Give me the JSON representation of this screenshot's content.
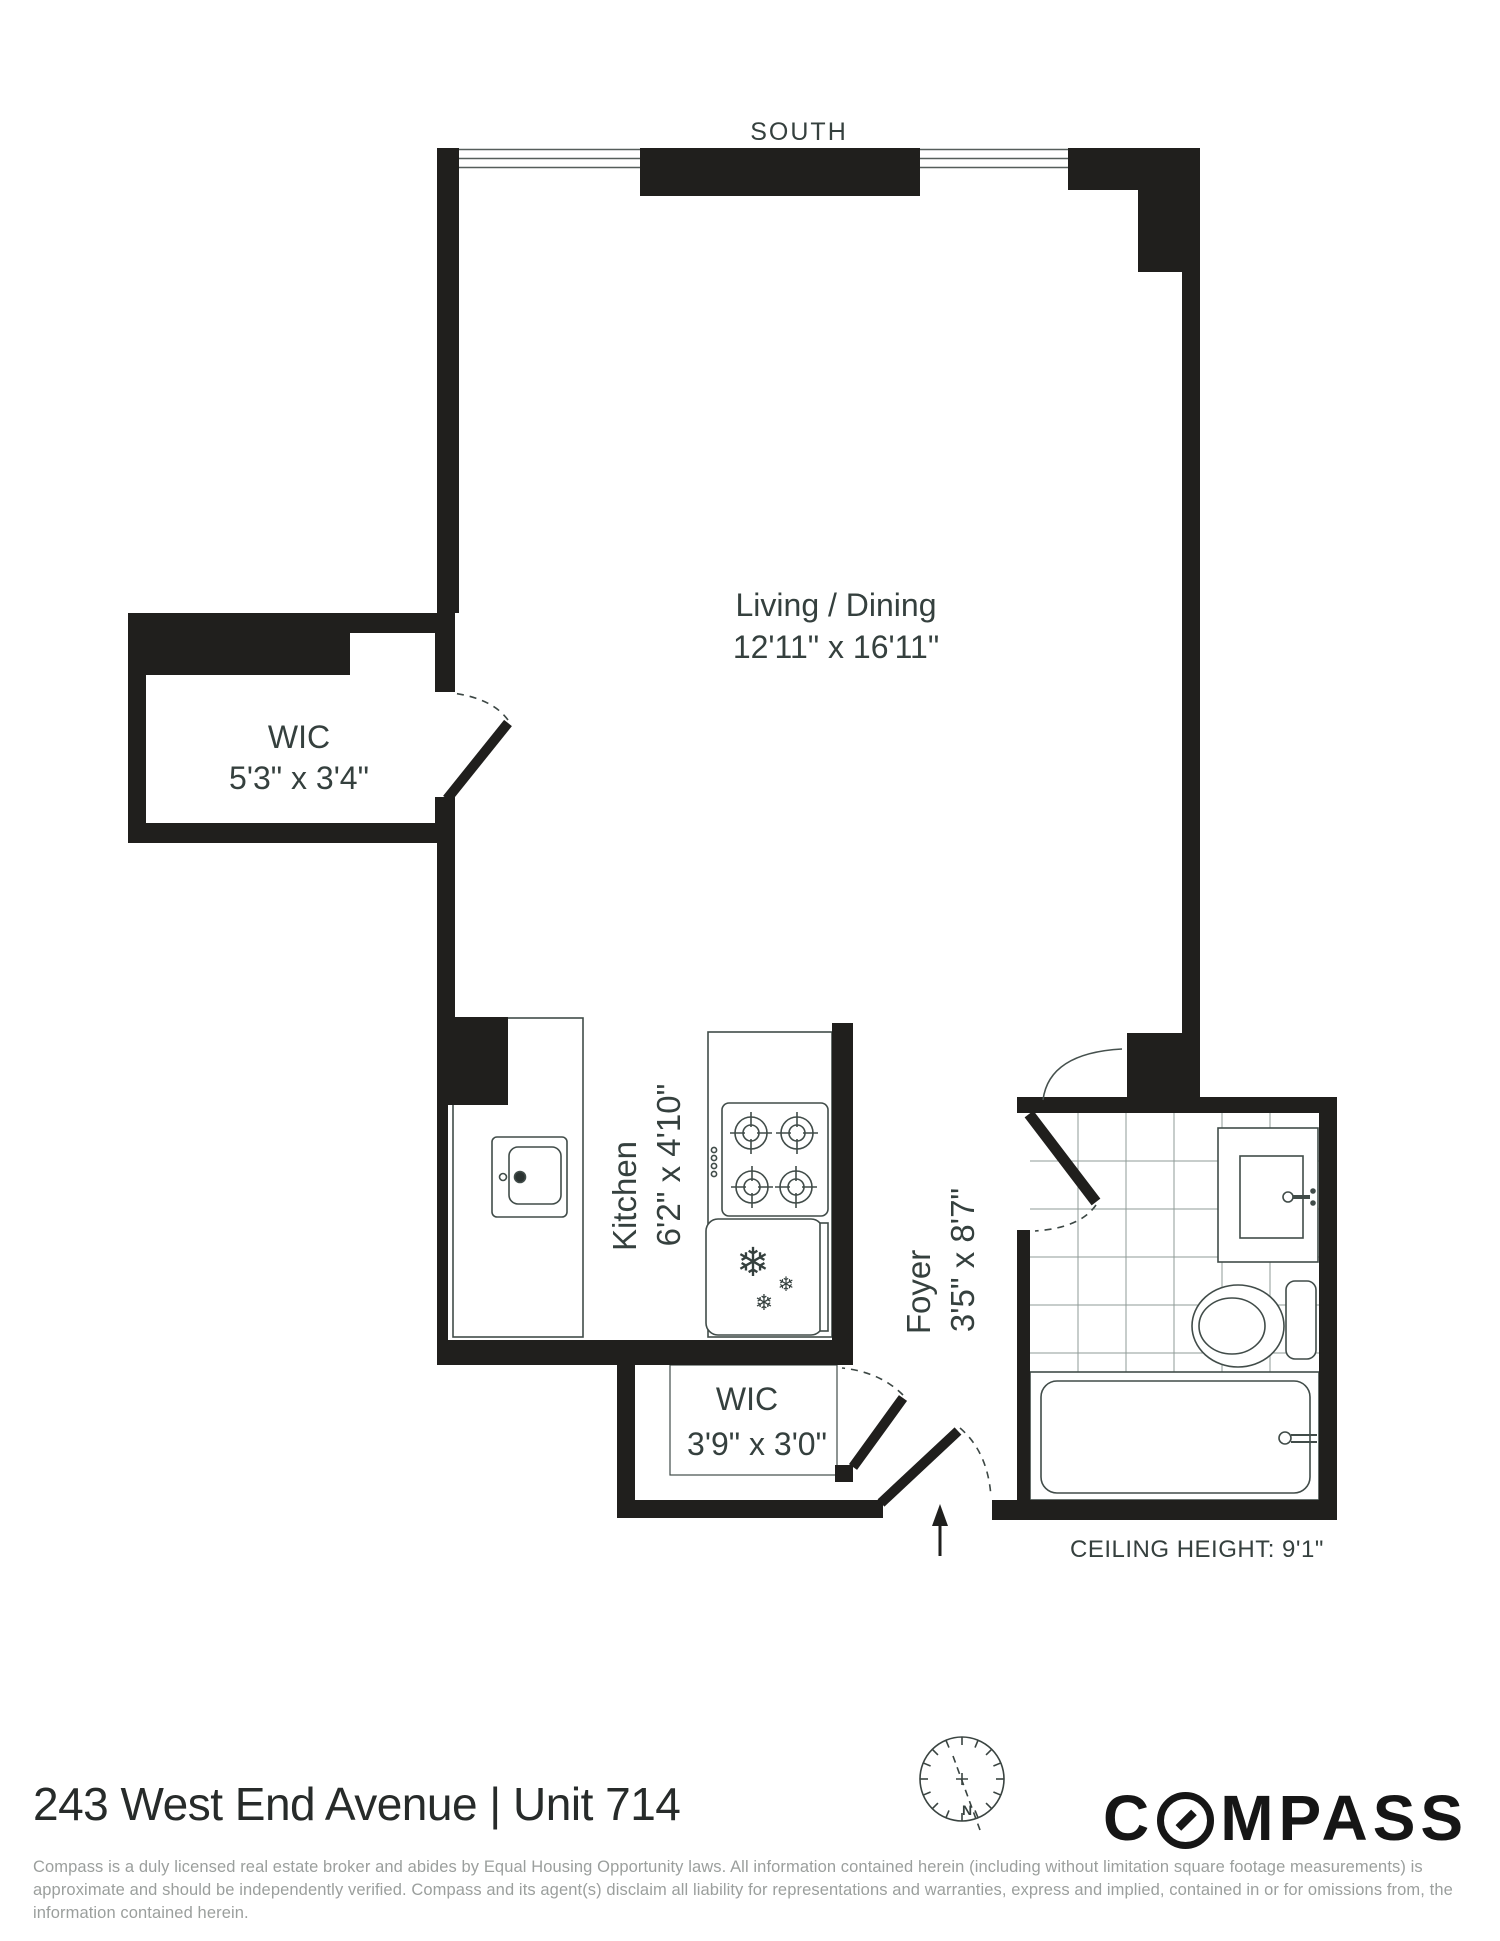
{
  "plan": {
    "compass_direction": "SOUTH",
    "north_label": "N",
    "rooms": {
      "living_dining": {
        "name": "Living / Dining",
        "dims": "12'11\" x 16'11\""
      },
      "wic_left": {
        "name": "WIC",
        "dims": "5'3\" x 3'4\""
      },
      "kitchen": {
        "name": "Kitchen",
        "dims": "6'2\" x 4'10\""
      },
      "foyer": {
        "name": "Foyer",
        "dims": "3'5\" x 8'7\""
      },
      "wic_entry": {
        "name": "WIC",
        "dims": "3'9\" x 3'0\""
      }
    },
    "ceiling_note": "CEILING HEIGHT: 9'1\"",
    "icons": {
      "snowflake": "❄"
    }
  },
  "footer": {
    "address_title": "243 West End Avenue | Unit 714",
    "logo": {
      "wordmark": "COMPASS",
      "prefix": "C",
      "suffix": "MPASS"
    },
    "disclaimer": "Compass is a duly licensed real estate broker and abides by Equal Housing Opportunity laws.  All information contained herein (including without limitation square footage measurements) is approximate and should be independently verified. Compass and its agent(s) disclaim all liability for representations and warranties, express and implied, contained in or for omissions from, the information contained herein."
  },
  "colors": {
    "wall": "#201f1d",
    "label": "#35403e",
    "fixture_line": "#414c49",
    "tile_line": "#8f9b97",
    "disclaimer_text": "#9b9f9d"
  }
}
